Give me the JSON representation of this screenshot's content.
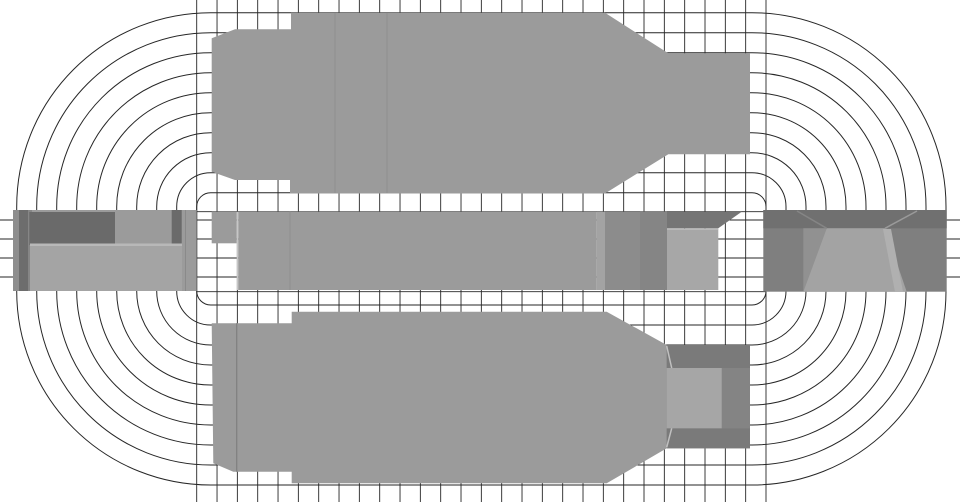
{
  "canvas": {
    "width": 960,
    "height": 502,
    "background": "#ffffff"
  },
  "colors": {
    "line": "#262626",
    "body": "#9b9b9b",
    "seam_light": "#c6c6c6"
  },
  "mesh": {
    "contours": {
      "comment": "concentric stadium flux/mesh contours around central band",
      "corner_left_cx": 210.7,
      "corner_top_cy": 206.7,
      "corner_right_cx": 752.0,
      "corner_bottom_cy": 291.0,
      "radius_start": 14,
      "radius_step": 20,
      "count": 10,
      "stroke_width": 1
    },
    "vertical_lines": {
      "x_start": 196.7,
      "x_end": 766.0,
      "count": 29,
      "y_top": 0,
      "y_bottom": 502,
      "stroke_width": 0.9
    },
    "band_lines": {
      "ys": [
        220.0,
        239.0,
        258.0,
        277.0
      ],
      "x_start": 0,
      "x_end": 960,
      "stroke_width": 0.9
    },
    "band_edge_lines": {
      "ys": [
        211.7,
        291.7
      ],
      "x_start": 196.7,
      "x_end": 766.0,
      "stroke_width": 0.9
    }
  },
  "parts": [
    {
      "name": "upper-yoke-body",
      "type": "polygon",
      "fill": "#9b9b9b",
      "pts": [
        [
          211.7,
          38.3
        ],
        [
          235,
          29.3
        ],
        [
          291,
          29.3
        ],
        [
          291,
          12.7
        ],
        [
          605,
          12.7
        ],
        [
          668.3,
          53.3
        ],
        [
          750,
          53.3
        ],
        [
          750,
          154.3
        ],
        [
          668.3,
          154.3
        ],
        [
          605,
          193.5
        ],
        [
          290,
          193.5
        ],
        [
          290,
          180
        ],
        [
          235,
          180
        ],
        [
          211.7,
          171.7
        ]
      ]
    },
    {
      "name": "upper-yoke-seam-1",
      "type": "line",
      "stroke": "#8f8f8f",
      "sw": 1,
      "x1": 335,
      "y1": 13,
      "x2": 335,
      "y2": 193
    },
    {
      "name": "upper-yoke-seam-2",
      "type": "line",
      "stroke": "#8f8f8f",
      "sw": 1,
      "x1": 387,
      "y1": 13,
      "x2": 387,
      "y2": 193
    },
    {
      "name": "lower-yoke-body",
      "type": "polygon",
      "fill": "#9b9b9b",
      "pts": [
        [
          211.7,
          323.3
        ],
        [
          291.7,
          323.3
        ],
        [
          291.7,
          311.7
        ],
        [
          606.7,
          311.7
        ],
        [
          666.7,
          345.0
        ],
        [
          750,
          345.0
        ],
        [
          750,
          448.3
        ],
        [
          666.7,
          448.3
        ],
        [
          606.7,
          483.3
        ],
        [
          291.7,
          483.3
        ],
        [
          291.7,
          471.7
        ],
        [
          233.3,
          471.7
        ],
        [
          213.3,
          463.3
        ]
      ]
    },
    {
      "name": "lower-yoke-seam",
      "type": "line",
      "stroke": "#7f7f7f",
      "sw": 1.2,
      "x1": 236.7,
      "y1": 323.3,
      "x2": 236.7,
      "y2": 471.7
    },
    {
      "name": "lower-socket-outer",
      "type": "rect",
      "fill": "#8d8d8d",
      "x": 666.7,
      "y": 345.0,
      "w": 83.3,
      "h": 103.3
    },
    {
      "name": "lower-socket-top-wall",
      "type": "rect",
      "fill": "#7a7a7a",
      "x": 666.7,
      "y": 345.0,
      "w": 83.3,
      "h": 23.0
    },
    {
      "name": "lower-socket-bottom-wall",
      "type": "rect",
      "fill": "#7a7a7a",
      "x": 666.7,
      "y": 428.3,
      "w": 83.3,
      "h": 20.0
    },
    {
      "name": "lower-socket-right-wall",
      "type": "rect",
      "fill": "#848484",
      "x": 721.7,
      "y": 368.0,
      "w": 28.3,
      "h": 60.3
    },
    {
      "name": "lower-socket-floor",
      "type": "rect",
      "fill": "#a6a6a6",
      "x": 666.7,
      "y": 368.0,
      "w": 55.0,
      "h": 60.3
    },
    {
      "name": "lower-socket-bevel-top",
      "type": "line",
      "stroke": "#c0c0c0",
      "sw": 1.5,
      "x1": 666.7,
      "y1": 346.0,
      "x2": 671.7,
      "y2": 368.0
    },
    {
      "name": "lower-socket-bevel-bottom",
      "type": "line",
      "stroke": "#c0c0c0",
      "sw": 1.5,
      "x1": 666.7,
      "y1": 447.3,
      "x2": 671.7,
      "y2": 428.3
    },
    {
      "name": "left-terminal-base",
      "type": "rect",
      "fill": "#9b9b9b",
      "x": 13,
      "y": 210,
      "w": 183.7,
      "h": 81
    },
    {
      "name": "left-terminal-edge-shade",
      "type": "rect",
      "fill": "#8e8e8e",
      "x": 13,
      "y": 210,
      "w": 6,
      "h": 81
    },
    {
      "name": "left-terminal-groove",
      "type": "rect",
      "fill": "#6d6d6d",
      "x": 19,
      "y": 210,
      "w": 9,
      "h": 81
    },
    {
      "name": "left-terminal-groove-fade",
      "type": "rect",
      "fill": "#868686",
      "x": 28,
      "y": 210,
      "w": 4,
      "h": 81
    },
    {
      "name": "left-terminal-wall-top",
      "type": "rect",
      "fill": "#6a6a6a",
      "x": 29.3,
      "y": 212,
      "w": 85.7,
      "h": 33
    },
    {
      "name": "left-terminal-wall-right",
      "type": "rect",
      "fill": "#6a6a6a",
      "x": 171.7,
      "y": 210,
      "w": 10,
      "h": 35
    },
    {
      "name": "left-terminal-floor-edge",
      "type": "rect",
      "fill": "#b8b8b8",
      "x": 30,
      "y": 243.5,
      "w": 152,
      "h": 2.5
    },
    {
      "name": "left-terminal-floor",
      "type": "rect",
      "fill": "#a4a4a4",
      "x": 30,
      "y": 246,
      "w": 152,
      "h": 45
    },
    {
      "name": "left-terminal-seam",
      "type": "line",
      "stroke": "#8a8a8a",
      "sw": 1,
      "x1": 185.5,
      "y1": 210,
      "x2": 185.5,
      "y2": 291
    },
    {
      "name": "center-bar-step",
      "type": "rect",
      "fill": "#9b9b9b",
      "x": 211.7,
      "y": 211.7,
      "w": 25,
      "h": 31.6
    },
    {
      "name": "center-bar-gap",
      "type": "rect",
      "fill": "#c6c6c6",
      "x": 236.7,
      "y": 211.7,
      "w": 1.6,
      "h": 78.3
    },
    {
      "name": "center-bar",
      "type": "rect",
      "fill": "#9b9b9b",
      "x": 238.3,
      "y": 211.7,
      "w": 358.4,
      "h": 78.3
    },
    {
      "name": "center-bar-seam",
      "type": "line",
      "stroke": "#8f8f8f",
      "sw": 1,
      "x1": 290,
      "y1": 211.7,
      "x2": 290,
      "y2": 290
    },
    {
      "name": "center-bar-light-strip",
      "type": "rect",
      "fill": "#a3a3a3",
      "x": 596.7,
      "y": 211.7,
      "w": 8.3,
      "h": 78.3
    },
    {
      "name": "center-bar-end-block",
      "type": "rect",
      "fill": "#8c8c8c",
      "x": 605,
      "y": 211.7,
      "w": 62,
      "h": 78.3
    },
    {
      "name": "center-bar-end-shade",
      "type": "rect",
      "fill": "#858585",
      "x": 640,
      "y": 211.7,
      "w": 27,
      "h": 78.3
    },
    {
      "name": "center-socket-top-wall",
      "type": "polygon",
      "fill": "#757575",
      "pts": [
        [
          667,
          211.7
        ],
        [
          741.7,
          211.7
        ],
        [
          718.3,
          228.3
        ],
        [
          667,
          228.3
        ]
      ]
    },
    {
      "name": "center-socket-floor",
      "type": "rect",
      "fill": "#a7a7a7",
      "x": 667,
      "y": 228.3,
      "w": 51.3,
      "h": 61.7
    },
    {
      "name": "center-socket-floor-edge",
      "type": "line",
      "stroke": "#bfbfbf",
      "sw": 1,
      "x1": 667,
      "y1": 229.3,
      "x2": 718.3,
      "y2": 229.3
    },
    {
      "name": "right-terminal-base",
      "type": "rect",
      "fill": "#7f7f7f",
      "x": 763.3,
      "y": 210,
      "w": 183.4,
      "h": 81.7
    },
    {
      "name": "right-terminal-top-wall",
      "type": "rect",
      "fill": "#707070",
      "x": 763.3,
      "y": 210,
      "w": 183.4,
      "h": 18.3
    },
    {
      "name": "right-terminal-wall-left",
      "type": "polygon",
      "fill": "#919191",
      "pts": [
        [
          803.3,
          228.3
        ],
        [
          826.7,
          228.3
        ],
        [
          803.3,
          291.7
        ]
      ]
    },
    {
      "name": "right-terminal-floor",
      "type": "polygon",
      "fill": "#a3a3a3",
      "pts": [
        [
          826.7,
          228.3
        ],
        [
          885,
          228.3
        ],
        [
          906.7,
          291.7
        ],
        [
          803.3,
          291.7
        ]
      ]
    },
    {
      "name": "right-terminal-bevel-left",
      "type": "line",
      "stroke": "#858585",
      "sw": 1.5,
      "x1": 826.7,
      "y1": 228.3,
      "x2": 797,
      "y2": 211
    },
    {
      "name": "right-terminal-bevel-right",
      "type": "line",
      "stroke": "#9a9a9a",
      "sw": 1.5,
      "x1": 885,
      "y1": 228.3,
      "x2": 917,
      "y2": 211
    },
    {
      "name": "right-terminal-light-strip",
      "type": "polygon",
      "fill": "#b0b0b0",
      "pts": [
        [
          883,
          229
        ],
        [
          891,
          229
        ],
        [
          903,
          291.7
        ],
        [
          895,
          291.7
        ]
      ]
    }
  ]
}
